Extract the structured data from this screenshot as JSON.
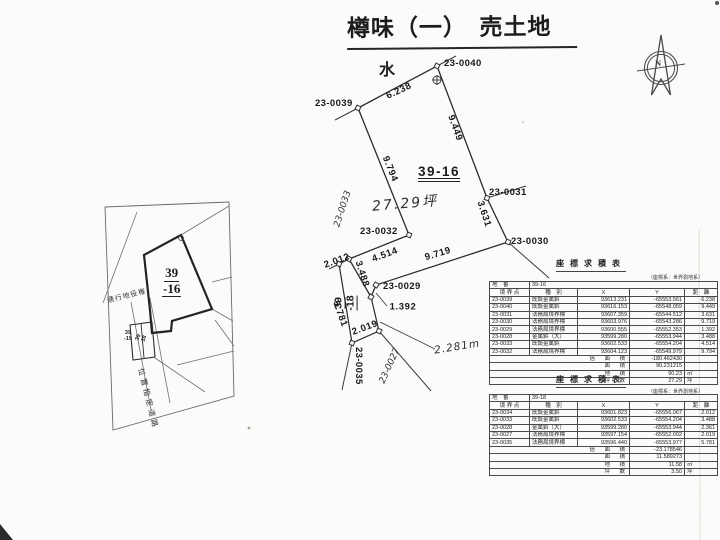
{
  "title": "樽味（一）　売土地",
  "compass": {
    "north": "N"
  },
  "plan": {
    "water": "水",
    "parcel_main": "39-16",
    "area_hand": "27.29坪",
    "points": {
      "p0040": "23-0040",
      "p0039": "23-0039",
      "p0032": "23-0032",
      "p0031": "23-0031",
      "p0030": "23-0030",
      "p0029": "23-0029",
      "p0035": "23-0035"
    },
    "strip": {
      "line1": "39",
      "line2": "-18"
    },
    "distances": {
      "d6238": "6.238",
      "d9449": "9.449",
      "d9794": "9.794",
      "d3631": "3.631",
      "d9719": "9.719",
      "d4514": "4.514",
      "d1392": "1.392",
      "d2012": "2.012",
      "d3488": "3.488",
      "d5781": "5.781",
      "d2019": "2.019"
    },
    "handwritten": {
      "p0033": "23-0033",
      "p0027": "23-0027",
      "length": "2.281m"
    }
  },
  "inset": {
    "parcel": {
      "line1": "39",
      "line2": "-16"
    },
    "easement": "通行地役権",
    "road": "位置指定道路",
    "small_parcels": {
      "left1": "39",
      "left2": "-19",
      "right1": "39",
      "right2": "-18"
    }
  },
  "tables": [
    {
      "title": "座標求積表",
      "datum_note": "（座標系：世界測地系）",
      "label_chiban": "地　番",
      "parcel": "39-16",
      "col_point": "境 界 点",
      "col_type": "種　別",
      "col_x": "X",
      "col_y": "Y",
      "col_dist": "距　離",
      "rows": [
        {
          "point": "23-0039",
          "type": "既設金属鋲",
          "x": "93613.231",
          "y": "-65553.561",
          "dist": "6.238"
        },
        {
          "point": "23-0040",
          "type": "既設金属鋲",
          "x": "93616.153",
          "y": "-65548.059",
          "dist": "9.449"
        },
        {
          "point": "23-0031",
          "type": "法務局境界標",
          "x": "93607.359",
          "y": "-65544.512",
          "dist": "3.631"
        },
        {
          "point": "23-0030",
          "type": "法務局境界標",
          "x": "93603.976",
          "y": "-65543.286",
          "dist": "9.719"
        },
        {
          "point": "23-0029",
          "type": "法務局境界標",
          "x": "93600.555",
          "y": "-65552.353",
          "dist": "1.392"
        },
        {
          "point": "23-0028",
          "type": "金属鋲（大）",
          "x": "93599.280",
          "y": "-65553.944",
          "dist": "3.488"
        },
        {
          "point": "23-0033",
          "type": "既設金属鋲",
          "x": "93602.533",
          "y": "-65554.204",
          "dist": "4.514"
        },
        {
          "point": "23-0032",
          "type": "法務局境界標",
          "x": "93604.123",
          "y": "-65549.979",
          "dist": "9.794"
        }
      ],
      "summary": [
        {
          "label": "倍　面　積",
          "value": "-180.462430",
          "unit": ""
        },
        {
          "label": "面　積",
          "value": "90.231215",
          "unit": ""
        },
        {
          "label": "地　積",
          "value": "90.23",
          "unit": "㎡"
        },
        {
          "label": "坪　数",
          "value": "27.29",
          "unit": "坪"
        }
      ]
    },
    {
      "title": "座標求積表",
      "datum_note": "（座標系：世界測地系）",
      "label_chiban": "地　番",
      "parcel": "39-18",
      "col_point": "境 界 点",
      "col_type": "種　別",
      "col_x": "X",
      "col_y": "Y",
      "col_dist": "距　離",
      "rows": [
        {
          "point": "23-0034",
          "type": "既設金属鋲",
          "x": "93601.823",
          "y": "-65556.067",
          "dist": "2.012"
        },
        {
          "point": "23-0033",
          "type": "既設金属鋲",
          "x": "93602.533",
          "y": "-65554.204",
          "dist": "3.488"
        },
        {
          "point": "23-0028",
          "type": "金属鋲（大）",
          "x": "93599.280",
          "y": "-65553.944",
          "dist": "2.361"
        },
        {
          "point": "23-0027",
          "type": "法務局境界標",
          "x": "93597.154",
          "y": "-65552.092",
          "dist": "2.019"
        },
        {
          "point": "23-0035",
          "type": "法務局境界標",
          "x": "93596.440",
          "y": "-65553.977",
          "dist": "5.781"
        }
      ],
      "summary": [
        {
          "label": "倍　面　積",
          "value": "-23.178546",
          "unit": ""
        },
        {
          "label": "面　積",
          "value": "11.589273",
          "unit": ""
        },
        {
          "label": "地　積",
          "value": "11.58",
          "unit": "㎡"
        },
        {
          "label": "坪　数",
          "value": "3.50",
          "unit": "坪"
        }
      ]
    }
  ]
}
